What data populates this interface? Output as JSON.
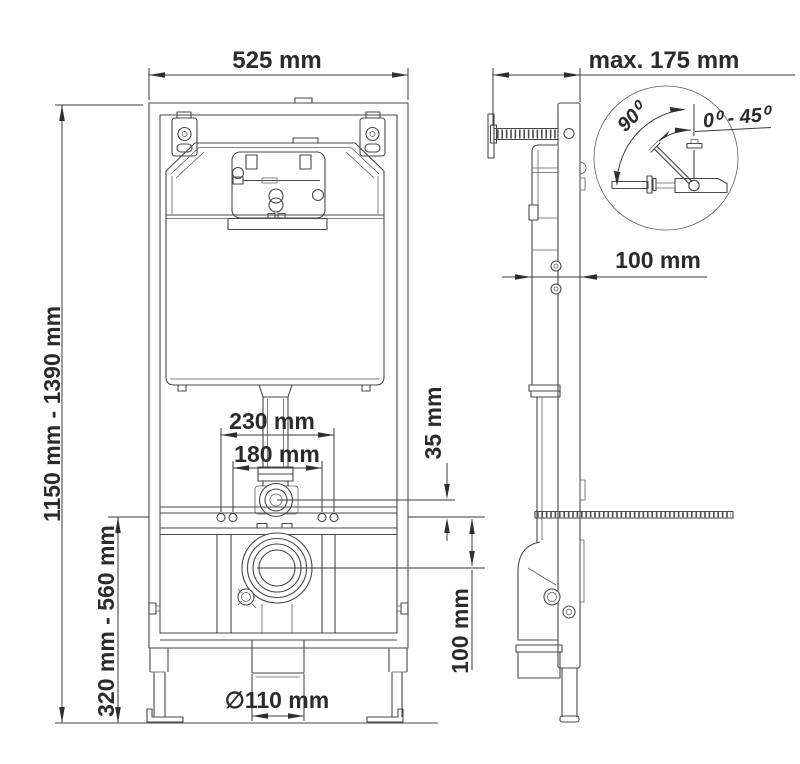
{
  "drawing": {
    "background": "#ffffff",
    "line_color": "#474747",
    "text_color": "#2b2b2b",
    "front_view": {
      "width": "525 mm",
      "overall_height": "1150 mm - 1390 mm",
      "wc_mount_height": "320 mm - 560 mm",
      "flush_holes_outer": "230 mm",
      "flush_holes_inner": "180 mm",
      "flush_elbow_offset": "35 mm",
      "drain_offset": "100 mm",
      "drain_diameter": "∅110 mm"
    },
    "side_view": {
      "max_depth": "max. 175 mm",
      "frame_depth": "100 mm"
    },
    "bracket_detail": {
      "angle_full": "90⁰",
      "angle_range": "0⁰ - 45⁰"
    }
  }
}
